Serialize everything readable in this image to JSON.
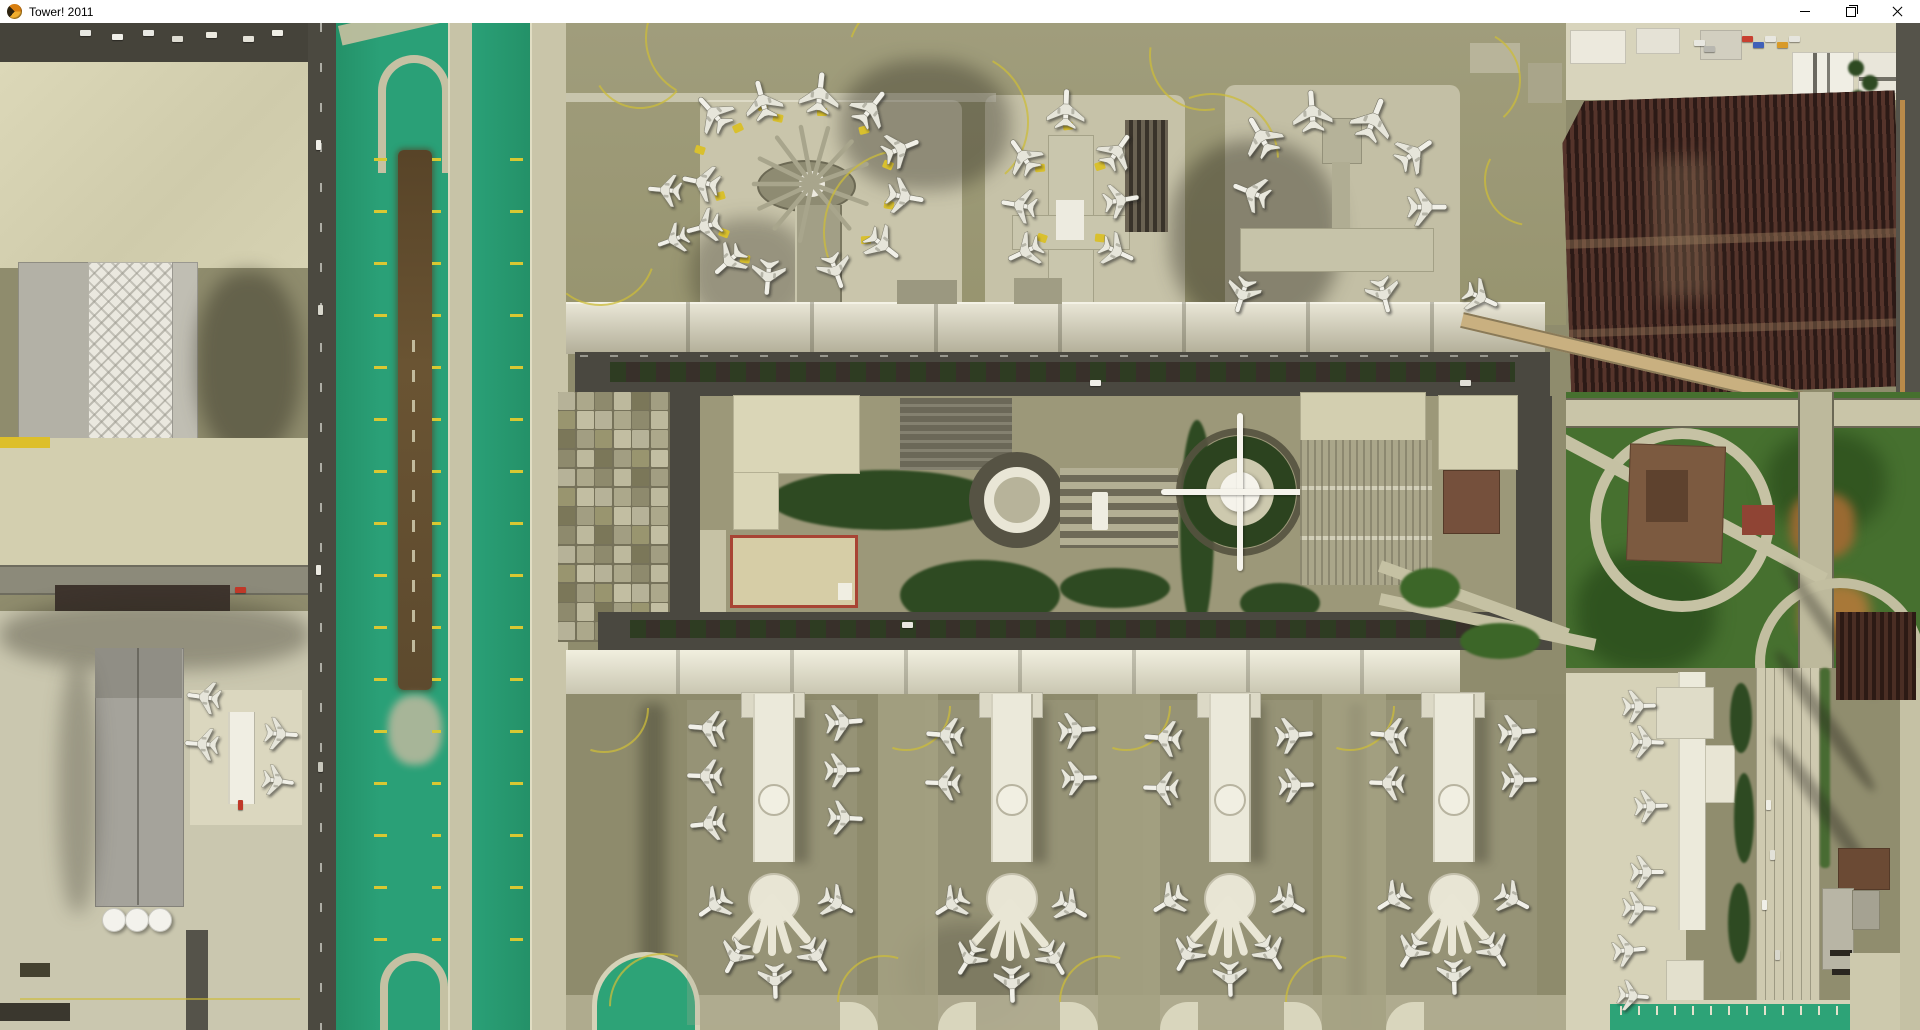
{
  "window": {
    "title": "Tower! 2011",
    "controls": {
      "minimize": "minimize-window",
      "maximize": "restore-window",
      "close": "close-window"
    }
  },
  "palette": {
    "titlebar_bg": "#ffffff",
    "tarmac_olive": "#8f8c6d",
    "apron_cream": "#d6d2b2",
    "grass_green": "#2aa077",
    "dirt_brown": "#5d4a2e",
    "taxi_line_yellow": "#d8c832",
    "asphalt_road": "#4a4840",
    "parking_lot_maroon": "#3a241f",
    "building_white": "#eceadb",
    "highlight_red_building_border": "#a84434",
    "interchange_green": "#46702f"
  },
  "map": {
    "origin_y_offset": 23,
    "aircraft_comment": "entries are [x, y, heading_deg, scale] in original screenshot pixels",
    "aircraft": [
      [
        712,
        112,
        -42,
        1
      ],
      [
        762,
        99,
        -15,
        1
      ],
      [
        820,
        92,
        6,
        1.05
      ],
      [
        872,
        107,
        38,
        1
      ],
      [
        902,
        148,
        68,
        0.95
      ],
      [
        906,
        197,
        100,
        0.95
      ],
      [
        884,
        246,
        128,
        0.95
      ],
      [
        836,
        272,
        160,
        0.9
      ],
      [
        700,
        182,
        -78,
        0.95
      ],
      [
        703,
        227,
        -105,
        0.9
      ],
      [
        728,
        262,
        -132,
        0.9
      ],
      [
        768,
        278,
        -175,
        0.9
      ],
      [
        664,
        190,
        -85,
        0.85
      ],
      [
        672,
        240,
        -110,
        0.8
      ],
      [
        1022,
        155,
        -35,
        0.95
      ],
      [
        1018,
        205,
        -80,
        0.9
      ],
      [
        1024,
        252,
        -115,
        0.9
      ],
      [
        1118,
        150,
        35,
        0.95
      ],
      [
        1122,
        200,
        80,
        0.9
      ],
      [
        1118,
        252,
        115,
        0.9
      ],
      [
        1066,
        108,
        2,
        1
      ],
      [
        1260,
        135,
        -30,
        1.05
      ],
      [
        1312,
        110,
        -4,
        1.05
      ],
      [
        1374,
        118,
        22,
        1.1
      ],
      [
        1416,
        152,
        55,
        1
      ],
      [
        1428,
        207,
        90,
        1
      ],
      [
        1250,
        192,
        -68,
        0.95
      ],
      [
        1384,
        296,
        165,
        0.9
      ],
      [
        1242,
        296,
        -162,
        0.9
      ],
      [
        1482,
        298,
        115,
        0.9
      ],
      [
        706,
        728,
        -85,
        0.95
      ],
      [
        704,
        776,
        -88,
        0.9
      ],
      [
        707,
        824,
        -96,
        0.9
      ],
      [
        845,
        722,
        85,
        0.95
      ],
      [
        843,
        770,
        88,
        0.9
      ],
      [
        846,
        818,
        93,
        0.9
      ],
      [
        713,
        906,
        -125,
        0.9
      ],
      [
        734,
        958,
        -152,
        0.9
      ],
      [
        775,
        982,
        178,
        0.9
      ],
      [
        817,
        957,
        148,
        0.9
      ],
      [
        838,
        904,
        118,
        0.9
      ],
      [
        944,
        735,
        -85,
        0.95
      ],
      [
        942,
        783,
        -88,
        0.9
      ],
      [
        1078,
        730,
        85,
        0.95
      ],
      [
        1080,
        778,
        88,
        0.9
      ],
      [
        950,
        905,
        -122,
        0.9
      ],
      [
        968,
        960,
        -148,
        0.9
      ],
      [
        1012,
        985,
        178,
        0.95
      ],
      [
        1055,
        960,
        150,
        0.9
      ],
      [
        1072,
        908,
        120,
        0.9
      ],
      [
        1162,
        738,
        -85,
        0.95
      ],
      [
        1160,
        788,
        -88,
        0.9
      ],
      [
        1295,
        735,
        85,
        0.95
      ],
      [
        1297,
        785,
        88,
        0.9
      ],
      [
        1168,
        902,
        -122,
        0.9
      ],
      [
        1186,
        956,
        -150,
        0.9
      ],
      [
        1230,
        980,
        178,
        0.9
      ],
      [
        1272,
        955,
        148,
        0.9
      ],
      [
        1290,
        903,
        120,
        0.9
      ],
      [
        1388,
        735,
        -85,
        0.95
      ],
      [
        1386,
        783,
        -88,
        0.9
      ],
      [
        1518,
        732,
        85,
        0.95
      ],
      [
        1520,
        780,
        88,
        0.9
      ],
      [
        1392,
        900,
        -122,
        0.9
      ],
      [
        1410,
        953,
        -148,
        0.9
      ],
      [
        1454,
        978,
        178,
        0.9
      ],
      [
        1496,
        952,
        148,
        0.9
      ],
      [
        1514,
        900,
        118,
        0.9
      ],
      [
        203,
        697,
        -82,
        0.85
      ],
      [
        201,
        744,
        -86,
        0.85
      ],
      [
        282,
        734,
        94,
        0.85
      ],
      [
        279,
        781,
        98,
        0.8
      ],
      [
        1640,
        706,
        88,
        0.85
      ],
      [
        1648,
        742,
        92,
        0.85
      ],
      [
        1652,
        806,
        88,
        0.85
      ],
      [
        1648,
        872,
        90,
        0.85
      ],
      [
        1640,
        908,
        92,
        0.85
      ],
      [
        1630,
        950,
        85,
        0.85
      ],
      [
        1634,
        996,
        95,
        0.8
      ]
    ],
    "jetways": [
      [
        738,
        128
      ],
      [
        778,
        118
      ],
      [
        822,
        112
      ],
      [
        864,
        130
      ],
      [
        888,
        165
      ],
      [
        889,
        205
      ],
      [
        866,
        240
      ],
      [
        720,
        196
      ],
      [
        724,
        233
      ],
      [
        745,
        259
      ],
      [
        1040,
        168
      ],
      [
        1100,
        166
      ],
      [
        1042,
        238
      ],
      [
        1100,
        238
      ],
      [
        1068,
        126
      ],
      [
        762,
        106
      ],
      [
        700,
        150
      ]
    ],
    "taxi_arcs": [
      [
        640,
        60,
        48,
        40
      ],
      [
        706,
        38,
        60,
        120
      ],
      [
        910,
        58,
        62,
        200
      ],
      [
        958,
        122,
        70,
        300
      ],
      [
        1205,
        55,
        55,
        80
      ],
      [
        1212,
        160,
        66,
        250
      ],
      [
        906,
        232,
        82,
        160
      ],
      [
        600,
        250,
        55,
        20
      ],
      [
        906,
        706,
        44,
        0
      ],
      [
        1126,
        706,
        44,
        0
      ],
      [
        1350,
        706,
        44,
        0
      ],
      [
        604,
        708,
        44,
        0
      ],
      [
        662,
        1006,
        52,
        180
      ],
      [
        884,
        1002,
        46,
        180
      ],
      [
        1106,
        1002,
        46,
        180
      ],
      [
        1332,
        1002,
        46,
        180
      ],
      [
        1470,
        80,
        50,
        300
      ],
      [
        1530,
        180,
        45,
        100
      ]
    ],
    "grass_ticks": {
      "columns": [
        {
          "x": 374,
          "w": 13
        },
        {
          "x": 432,
          "w": 9
        },
        {
          "x": 510,
          "w": 13
        }
      ],
      "y_start": 158,
      "y_end": 988,
      "step": 52,
      "h": 3
    },
    "bottom_ticks": {
      "x_start": 1620,
      "x_end": 1840,
      "step": 18,
      "y": 1006,
      "w": 2,
      "h": 9,
      "color": "#e4e2cc"
    },
    "parking_grid": {
      "x": 558,
      "y": 392,
      "cols": 6,
      "rows": 13,
      "cell_w": 17,
      "cell_h": 17.6,
      "gap": 1.6,
      "colors": [
        "#b6b298",
        "#a29e82",
        "#8e8a6d",
        "#c2bea2",
        "#7b7759",
        "#aca88b",
        "#99956f",
        "#bdb99d"
      ]
    },
    "t1_spokes": {
      "x": 812,
      "y": 184,
      "len": 58,
      "angles": [
        -115,
        -90,
        -64,
        -37,
        -11,
        16,
        43,
        70,
        110,
        140,
        -140,
        -168
      ]
    },
    "south_piers": {
      "hubs": [
        {
          "x": 772,
          "y": 898
        },
        {
          "x": 1010,
          "y": 903
        },
        {
          "x": 1228,
          "y": 900
        },
        {
          "x": 1452,
          "y": 898
        }
      ],
      "finger_angles": [
        140,
        163,
        180,
        197,
        222
      ],
      "finger_len": 54
    },
    "apron_columns": [
      {
        "x": 878,
        "w": 60
      },
      {
        "x": 1098,
        "w": 62
      },
      {
        "x": 1322,
        "w": 64
      }
    ],
    "vehicles_comment": "[x, y, color, vertical]",
    "vehicles": [
      [
        80,
        30,
        "#e8e8e2",
        0
      ],
      [
        112,
        34,
        "#f0efe8",
        0
      ],
      [
        143,
        30,
        "#e8e8e2",
        0
      ],
      [
        172,
        36,
        "#dedcd2",
        0
      ],
      [
        206,
        32,
        "#eceae0",
        0
      ],
      [
        243,
        36,
        "#e4e2d8",
        0
      ],
      [
        272,
        30,
        "#efeee6",
        0
      ],
      [
        316,
        140,
        "#f0efe8",
        1
      ],
      [
        318,
        305,
        "#d8d7cc",
        1
      ],
      [
        316,
        565,
        "#eceae2",
        1
      ],
      [
        318,
        762,
        "#c8c7bc",
        1
      ],
      [
        1742,
        36,
        "#c84030",
        0
      ],
      [
        1753,
        42,
        "#4060b8",
        0
      ],
      [
        1765,
        36,
        "#e8e7e0",
        0
      ],
      [
        1777,
        42,
        "#d89a28",
        0
      ],
      [
        1789,
        36,
        "#e6e5de",
        0
      ],
      [
        1694,
        40,
        "#e8e7e0",
        0
      ],
      [
        1704,
        46,
        "#b8b7b0",
        0
      ],
      [
        1090,
        380,
        "#f0efe8",
        0
      ],
      [
        902,
        622,
        "#e8e7df",
        0
      ],
      [
        1460,
        380,
        "#e0dfd6",
        0
      ],
      [
        235,
        587,
        "#c03828",
        0
      ],
      [
        238,
        800,
        "#c03828",
        1
      ],
      [
        1766,
        800,
        "#efeee6",
        1
      ],
      [
        1770,
        850,
        "#e2e1d8",
        1
      ],
      [
        1762,
        900,
        "#f0efe8",
        1
      ],
      [
        1775,
        950,
        "#d8d7cc",
        1
      ]
    ]
  }
}
